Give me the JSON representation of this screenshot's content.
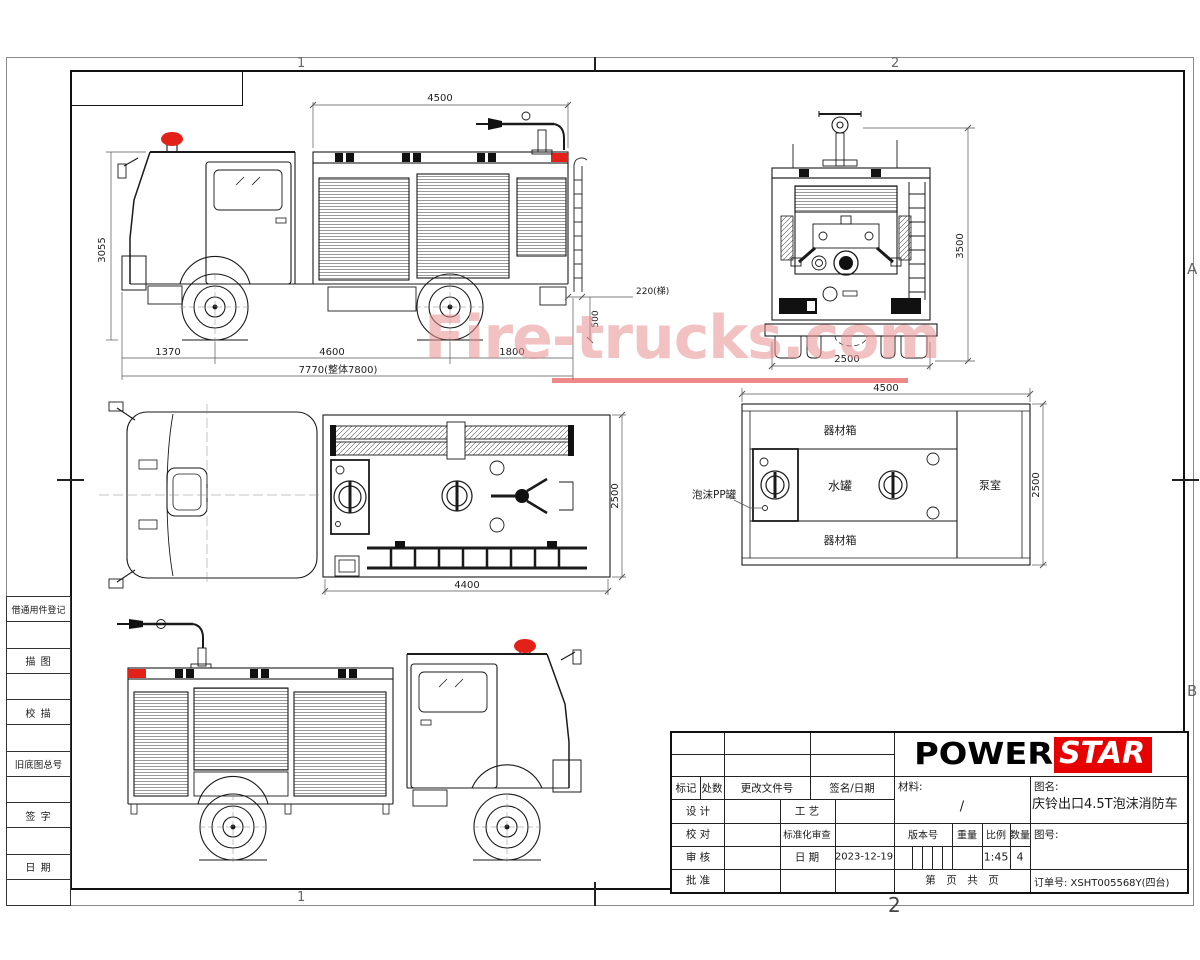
{
  "frame": {
    "zones": {
      "top1": "1",
      "top2": "2",
      "bottom1": "1",
      "bottom2": "2",
      "rightA": "A",
      "rightB": "B"
    }
  },
  "left_panel": {
    "items": [
      "借通用件登记",
      "描 图",
      "校 描",
      "旧底图总号",
      "签 字",
      "日 期"
    ]
  },
  "watermark": {
    "text": "Fire-trucks.com"
  },
  "colors": {
    "beacon_red": "#e32119",
    "logo_red": "#e60000",
    "watermark_pink": "#e88f8f"
  },
  "views": {
    "side": {
      "dims": {
        "top": "4500",
        "height": "3055",
        "front": "1370",
        "wheelbase": "4600",
        "rear": "1800",
        "total": "7770(整体7800)",
        "ladder": "220(梯)",
        "h500": "500"
      }
    },
    "rear": {
      "dims": {
        "height": "3500",
        "width": "2500"
      }
    },
    "plan": {
      "dims": {
        "body": "4400",
        "width": "2500"
      }
    },
    "tank": {
      "dims": {
        "length": "4500",
        "width": "2500"
      },
      "labels": {
        "top_box": "器材箱",
        "bottom_box": "器材箱",
        "foam": "泡沫PP罐",
        "water": "水罐",
        "pump": "泵室"
      }
    }
  },
  "title_block": {
    "logo": {
      "power": "POWER",
      "star": "STAR"
    },
    "header": {
      "mark": "标记",
      "count": "处数",
      "change_doc": "更改文件号",
      "sign_date": "签名/日期"
    },
    "rows": {
      "design": "设 计",
      "craft": "工 艺",
      "check": "校 对",
      "std": "标准化审查",
      "audit": "审 核",
      "date_label": "日 期",
      "date_value": "2023-12-19",
      "approve": "批 准"
    },
    "material": {
      "label": "材料:",
      "value": "/"
    },
    "spec": {
      "version": "版本号",
      "weight": "重量",
      "scale_label": "比例",
      "scale_value": "1:45",
      "qty_label": "数量",
      "qty_value": "4"
    },
    "pages": "第　页　共　页",
    "name_label": "图名:",
    "name_value": "庆铃出口4.5T泡沫消防车",
    "no_label": "图号:",
    "order": "订单号: XSHT005568Y(四台)"
  }
}
